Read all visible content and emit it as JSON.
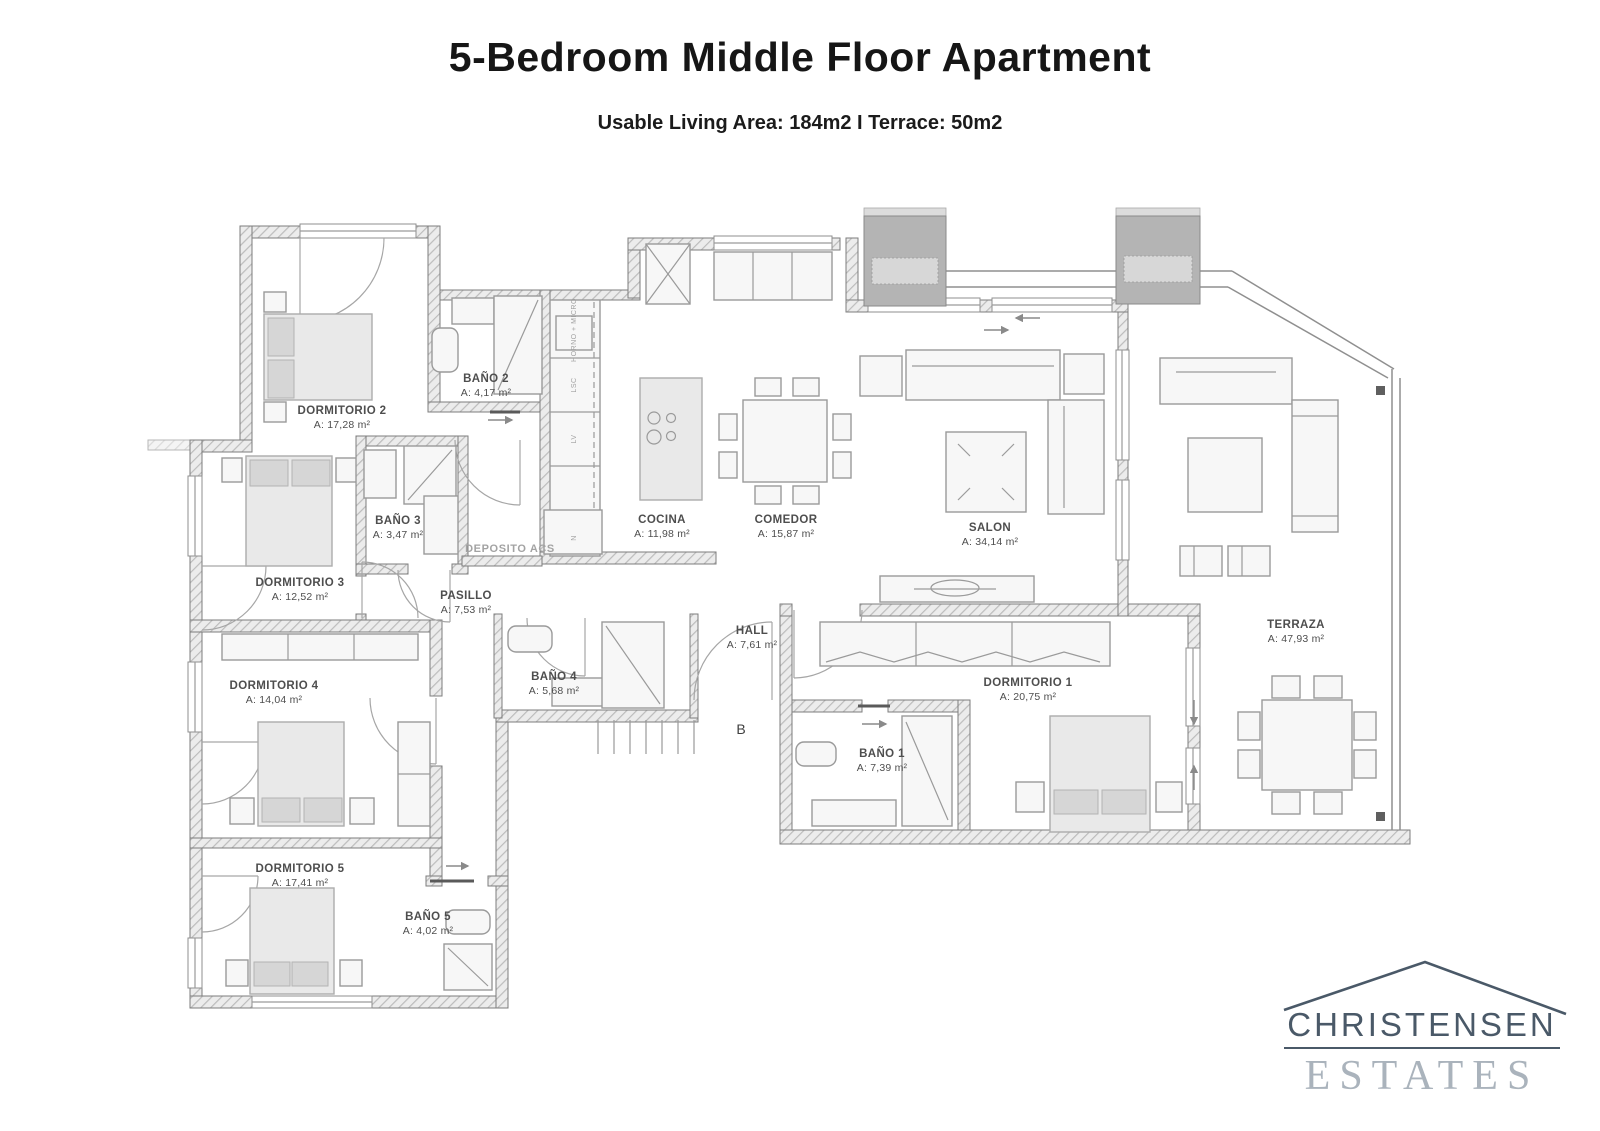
{
  "page": {
    "title": "5-Bedroom Middle Floor Apartment",
    "subtitle": "Usable Living Area: 184m2 I Terrace: 50m2"
  },
  "plan": {
    "rooms": {
      "dormitorio1": {
        "name": "DORMITORIO 1",
        "area": "A: 20,75 m²"
      },
      "dormitorio2": {
        "name": "DORMITORIO 2",
        "area": "A: 17,28 m²"
      },
      "dormitorio3": {
        "name": "DORMITORIO 3",
        "area": "A: 12,52 m²"
      },
      "dormitorio4": {
        "name": "DORMITORIO 4",
        "area": "A: 14,04 m²"
      },
      "dormitorio5": {
        "name": "DORMITORIO 5",
        "area": "A: 17,41 m²"
      },
      "banyo1": {
        "name": "BAÑO 1",
        "area": "A: 7,39 m²"
      },
      "banyo2": {
        "name": "BAÑO 2",
        "area": "A: 4,17 m²"
      },
      "banyo3": {
        "name": "BAÑO 3",
        "area": "A: 3,47 m²"
      },
      "banyo4": {
        "name": "BAÑO 4",
        "area": "A: 5,68 m²"
      },
      "banyo5": {
        "name": "BAÑO 5",
        "area": "A: 4,02 m²"
      },
      "cocina": {
        "name": "COCINA",
        "area": "A: 11,98 m²"
      },
      "comedor": {
        "name": "COMEDOR",
        "area": "A: 15,87 m²"
      },
      "salon": {
        "name": "SALON",
        "area": "A: 34,14 m²"
      },
      "hall": {
        "name": "HALL",
        "area": "A: 7,61 m²"
      },
      "pasillo": {
        "name": "PASILLO",
        "area": "A: 7,53 m²"
      },
      "terraza": {
        "name": "TERRAZA",
        "area": "A: 47,93 m²"
      }
    },
    "annotations": {
      "deposito": "DEPOSITO ACS",
      "entrance_label": "B",
      "horno": "HORNO + MICRO",
      "lsc": "LSC",
      "lv": "LV",
      "n": "N"
    }
  },
  "logo": {
    "line1": "CHRISTENSEN",
    "line2": "ESTATES"
  },
  "colors": {
    "logo_dark": "#4a5968",
    "logo_light": "#aab3bc",
    "wall": "#8c8c8c",
    "text": "#4e4e4e"
  }
}
